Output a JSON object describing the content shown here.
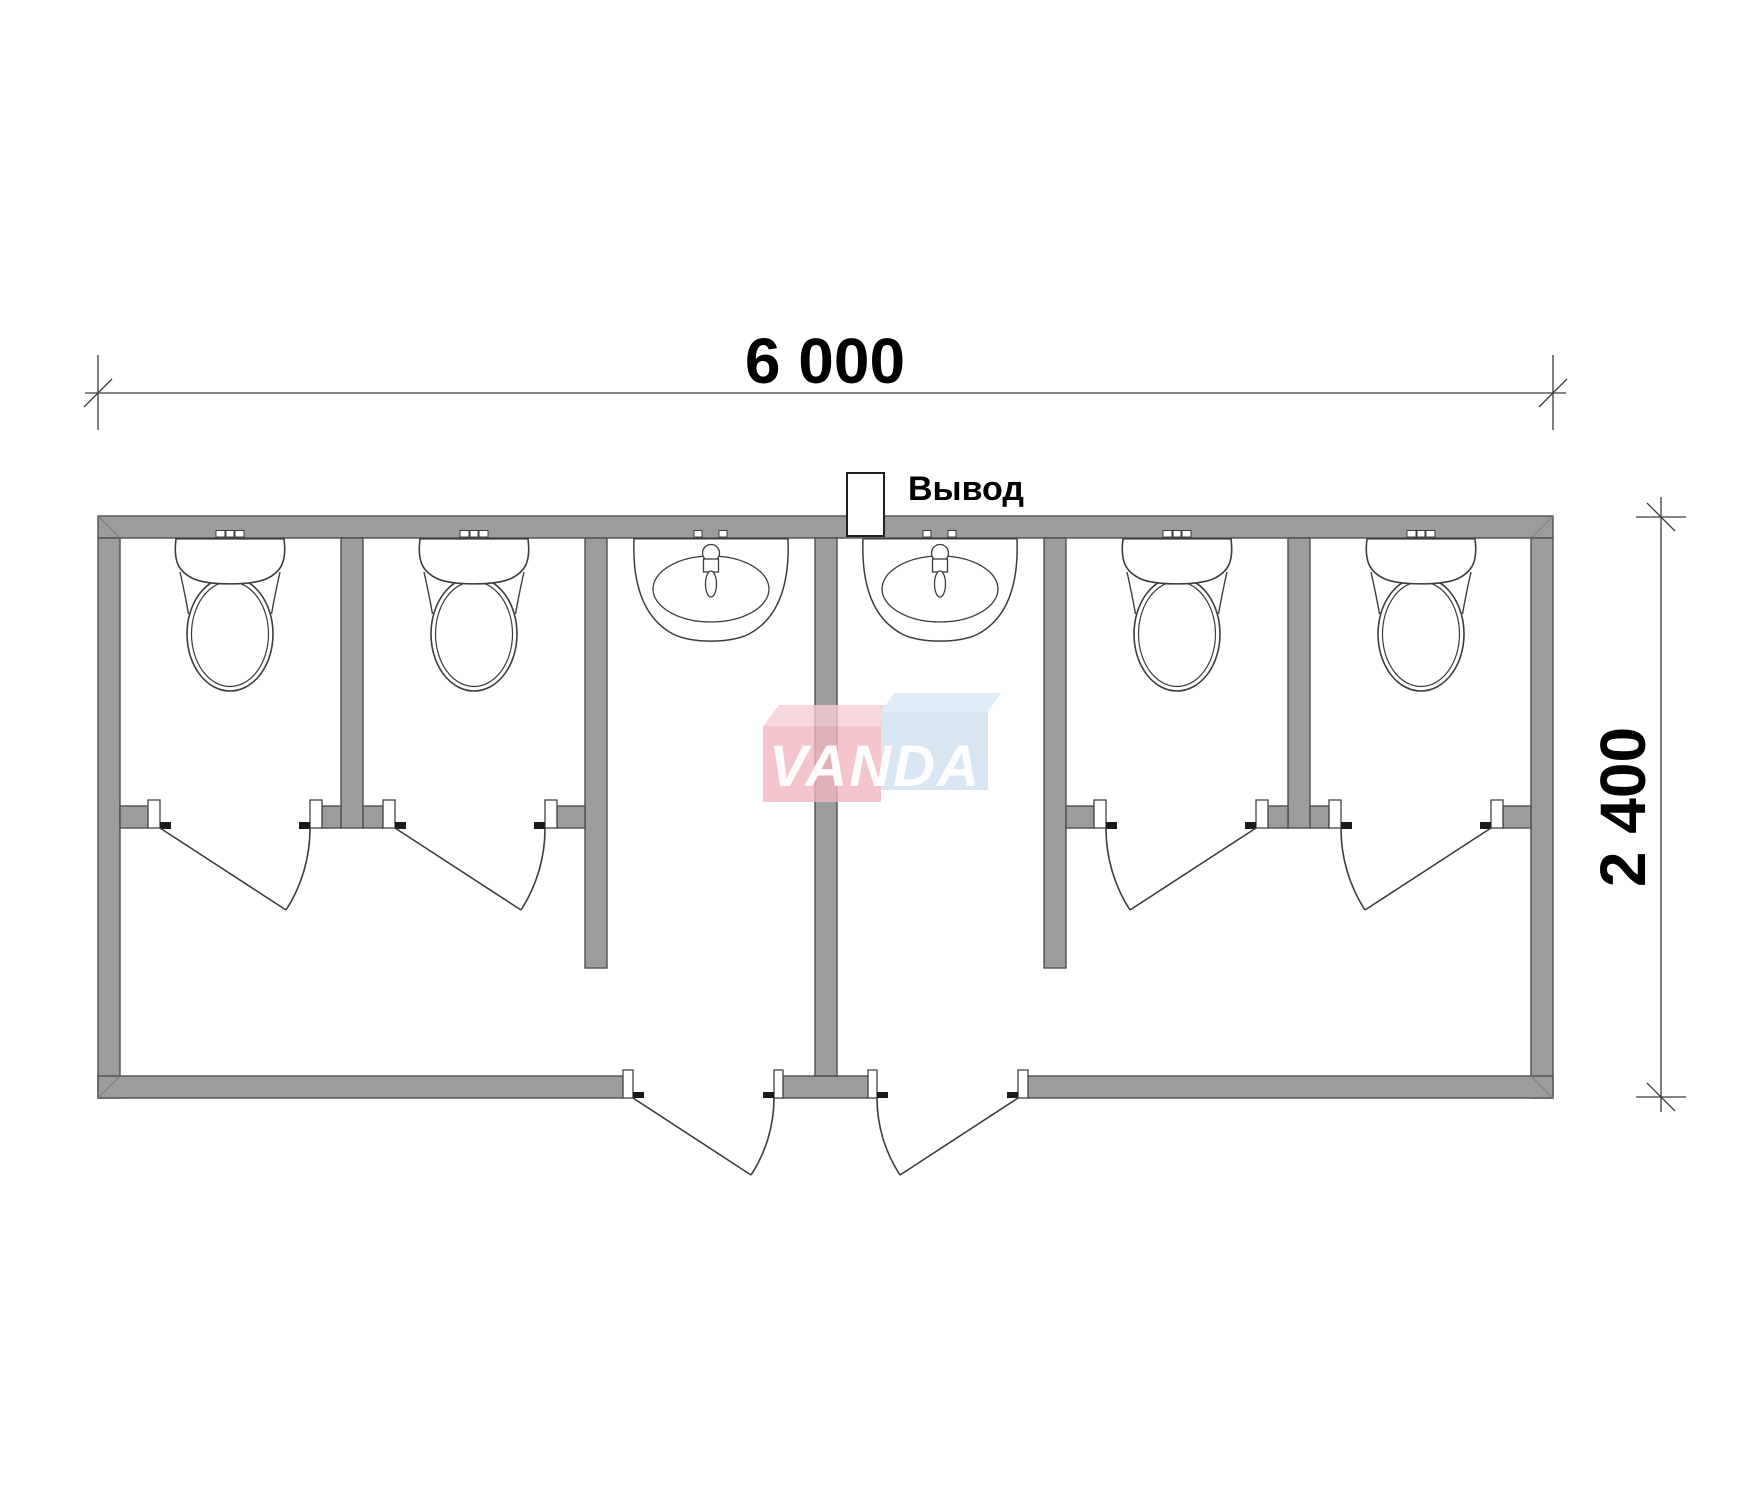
{
  "page": {
    "background": "#ffffff"
  },
  "plan": {
    "kind": "sanitary-container-floor-plan",
    "dimensions": {
      "width_label": "6 000",
      "depth_label": "2 400"
    },
    "outlet": {
      "label": "Вывод"
    },
    "fixtures": {
      "toilets": 4,
      "washbasins": 2,
      "swing_doors": 6
    },
    "colors": {
      "wall": "#9c9c9c",
      "wall_outline": "#4f4f4f",
      "line": "#3d3d3d",
      "dim": "#3c3c3c",
      "text": "#000000"
    }
  },
  "watermark": {
    "text": "VANDA",
    "text_color": "#ffffff",
    "left_block_face": "#f2b7c1",
    "left_block_top": "#f6cdd4",
    "right_block_face": "#cfe0f0",
    "right_block_top": "#dcebf6"
  }
}
